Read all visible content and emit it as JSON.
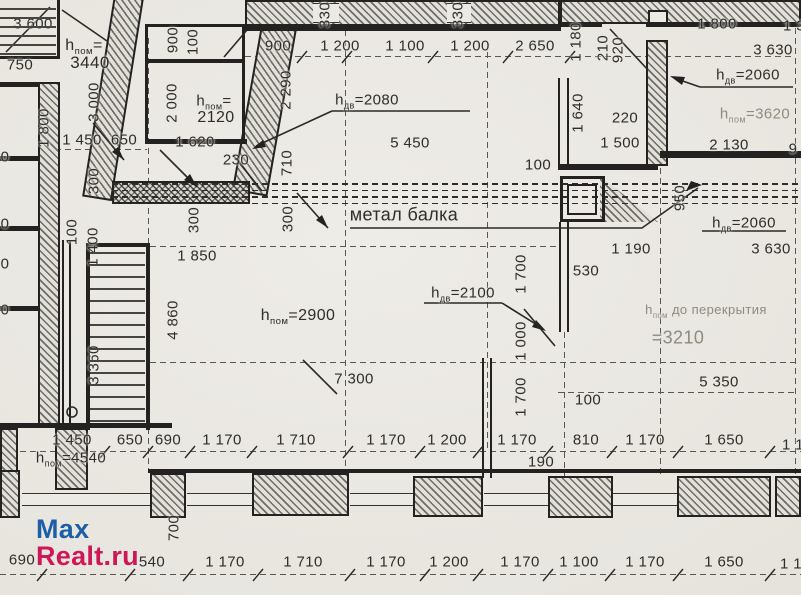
{
  "watermark": {
    "part1": "Max",
    "part2": "Realt.ru",
    "color1": "#1d5fa7",
    "color2": "#cf1659"
  },
  "plan": {
    "beam_label": "метал балка",
    "accent_ink": "#232220",
    "paper": "#e9e6e0",
    "labels": [
      {
        "t": "3 600",
        "x": 33,
        "y": 24
      },
      {
        "t": "750",
        "x": 20,
        "y": 65
      },
      {
        "t": "1 800",
        "x": 44,
        "y": 128,
        "r": 1
      },
      {
        "t": "3 000",
        "x": 94,
        "y": 102,
        "r": 1
      },
      {
        "t": "1 450",
        "x": 82,
        "y": 140
      },
      {
        "t": "650",
        "x": 124,
        "y": 140
      },
      {
        "h": "пом",
        "t": "=",
        "x": 84,
        "y": 47,
        "s": 16
      },
      {
        "t": "3440",
        "x": 90,
        "y": 63,
        "s": 17
      },
      {
        "t": "900",
        "x": 173,
        "y": 40,
        "r": 1
      },
      {
        "t": "100",
        "x": 193,
        "y": 42,
        "r": 1
      },
      {
        "t": "2 000",
        "x": 172,
        "y": 103,
        "r": 1
      },
      {
        "h": "пом",
        "t": "=",
        "x": 214,
        "y": 102
      },
      {
        "t": "2120",
        "x": 216,
        "y": 118,
        "s": 16
      },
      {
        "t": "1 620",
        "x": 195,
        "y": 142
      },
      {
        "t": "230",
        "x": 236,
        "y": 160
      },
      {
        "t": "300",
        "x": 94,
        "y": 181,
        "r": 1
      },
      {
        "t": "100",
        "x": 72,
        "y": 232,
        "r": 1
      },
      {
        "t": "1 400",
        "x": 93,
        "y": 247,
        "r": 1
      },
      {
        "t": "330",
        "x": 325,
        "y": 15,
        "r": 1
      },
      {
        "t": "330",
        "x": 458,
        "y": 15,
        "r": 1
      },
      {
        "t": "900",
        "x": 278,
        "y": 46
      },
      {
        "t": "1 200",
        "x": 340,
        "y": 46
      },
      {
        "t": "1 100",
        "x": 405,
        "y": 46
      },
      {
        "t": "1 200",
        "x": 470,
        "y": 46
      },
      {
        "t": "2 650",
        "x": 535,
        "y": 46
      },
      {
        "t": "2 290",
        "x": 286,
        "y": 90,
        "r": 1
      },
      {
        "h": "дв",
        "t": "=2080",
        "x": 367,
        "y": 101
      },
      {
        "t": "5 450",
        "x": 410,
        "y": 143
      },
      {
        "t": "710",
        "x": 287,
        "y": 163,
        "r": 1
      },
      {
        "t": "1 180",
        "x": 576,
        "y": 42,
        "r": 1
      },
      {
        "t": "210",
        "x": 603,
        "y": 48,
        "r": 1
      },
      {
        "t": "920",
        "x": 618,
        "y": 50,
        "r": 1
      },
      {
        "t": "1 800",
        "x": 717,
        "y": 24
      },
      {
        "t": "1 3",
        "x": 794,
        "y": 26
      },
      {
        "t": "3 630",
        "x": 773,
        "y": 50
      },
      {
        "h": "дв",
        "t": "=2060",
        "x": 748,
        "y": 76
      },
      {
        "h": "пом",
        "t": "=3620",
        "x": 755,
        "y": 115,
        "f": 1
      },
      {
        "t": "2 130",
        "x": 729,
        "y": 145
      },
      {
        "t": "9",
        "x": 793,
        "y": 149
      },
      {
        "t": "1 640",
        "x": 578,
        "y": 113,
        "r": 1
      },
      {
        "t": "220",
        "x": 625,
        "y": 118
      },
      {
        "t": "1 500",
        "x": 620,
        "y": 143
      },
      {
        "t": "100",
        "x": 538,
        "y": 165
      },
      {
        "t": "0",
        "x": 5,
        "y": 157
      },
      {
        "t": "0",
        "x": 5,
        "y": 224
      },
      {
        "t": "0",
        "x": 5,
        "y": 264
      },
      {
        "t": "0",
        "x": 5,
        "y": 310
      },
      {
        "t": "300",
        "x": 194,
        "y": 220,
        "r": 1
      },
      {
        "t": "300",
        "x": 288,
        "y": 219,
        "r": 1
      },
      {
        "t": "метал балка",
        "x": 404,
        "y": 215,
        "s": 18
      },
      {
        "t": "950",
        "x": 680,
        "y": 198,
        "r": 1
      },
      {
        "h": "дв",
        "t": "=2060",
        "x": 744,
        "y": 224
      },
      {
        "t": "1 190",
        "x": 631,
        "y": 249
      },
      {
        "t": "3 630",
        "x": 771,
        "y": 249
      },
      {
        "t": "530",
        "x": 586,
        "y": 271
      },
      {
        "t": "1 850",
        "x": 197,
        "y": 256
      },
      {
        "t": "1 700",
        "x": 521,
        "y": 274,
        "r": 1
      },
      {
        "h": "пом",
        "t": "=2900",
        "x": 298,
        "y": 317,
        "s": 16
      },
      {
        "h": "дв",
        "t": "=2100",
        "x": 463,
        "y": 294
      },
      {
        "t": "1 000",
        "x": 521,
        "y": 341,
        "r": 1
      },
      {
        "h": "пом",
        "t": " до перекрытия",
        "x": 706,
        "y": 311,
        "f": 1,
        "s": 13
      },
      {
        "t": "=3210",
        "x": 678,
        "y": 338,
        "f": 1,
        "s": 18
      },
      {
        "t": "4 860",
        "x": 173,
        "y": 320,
        "r": 1
      },
      {
        "t": "3 360",
        "x": 94,
        "y": 365,
        "r": 1
      },
      {
        "t": "7 300",
        "x": 354,
        "y": 379
      },
      {
        "t": "5 350",
        "x": 719,
        "y": 382
      },
      {
        "t": "1 700",
        "x": 521,
        "y": 397,
        "r": 1
      },
      {
        "t": "100",
        "x": 588,
        "y": 400
      },
      {
        "t": "1 450",
        "x": 72,
        "y": 440
      },
      {
        "t": "650",
        "x": 130,
        "y": 440
      },
      {
        "t": "690",
        "x": 168,
        "y": 440
      },
      {
        "t": "1 170",
        "x": 222,
        "y": 440
      },
      {
        "t": "1 710",
        "x": 296,
        "y": 440
      },
      {
        "t": "1 170",
        "x": 386,
        "y": 440
      },
      {
        "t": "1 200",
        "x": 447,
        "y": 440
      },
      {
        "t": "1 170",
        "x": 517,
        "y": 440
      },
      {
        "t": "810",
        "x": 586,
        "y": 440
      },
      {
        "t": "1 170",
        "x": 645,
        "y": 440
      },
      {
        "t": "1 650",
        "x": 724,
        "y": 440
      },
      {
        "t": "1 1",
        "x": 793,
        "y": 445
      },
      {
        "t": "190",
        "x": 541,
        "y": 462
      },
      {
        "h": "пом",
        "t": "=4540",
        "x": 71,
        "y": 459
      },
      {
        "t": "700",
        "x": 174,
        "y": 528,
        "r": 1
      },
      {
        "t": "690",
        "x": 22,
        "y": 560
      },
      {
        "t": "540",
        "x": 152,
        "y": 562
      },
      {
        "t": "1 170",
        "x": 225,
        "y": 562
      },
      {
        "t": "1 710",
        "x": 303,
        "y": 562
      },
      {
        "t": "1 170",
        "x": 386,
        "y": 562
      },
      {
        "t": "1 200",
        "x": 449,
        "y": 562
      },
      {
        "t": "1 170",
        "x": 520,
        "y": 562
      },
      {
        "t": "1 100",
        "x": 579,
        "y": 562
      },
      {
        "t": "1 170",
        "x": 645,
        "y": 562
      },
      {
        "t": "1 650",
        "x": 724,
        "y": 562
      },
      {
        "t": "1 1",
        "x": 791,
        "y": 564
      }
    ]
  }
}
